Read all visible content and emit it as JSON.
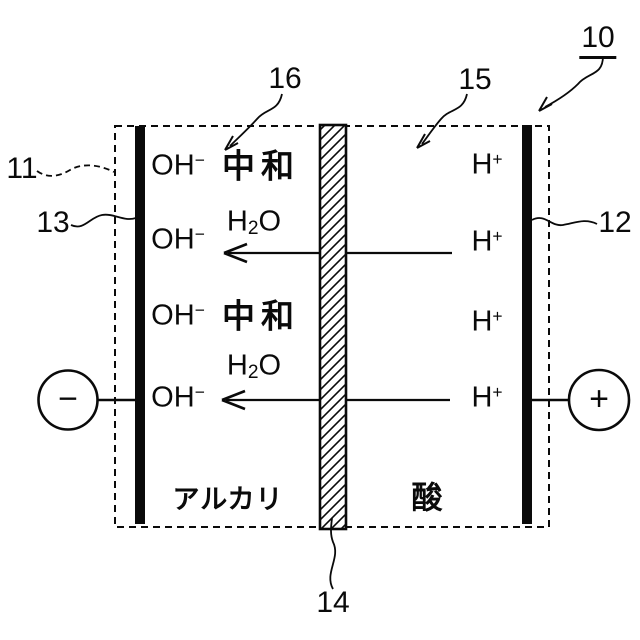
{
  "figure": {
    "background": "#ffffff",
    "line_color": "#0a0a0a"
  },
  "reference_labels": {
    "overall": "10",
    "vessel": "11",
    "right_electrode": "12",
    "left_electrode": "13",
    "membrane": "14",
    "acid_side": "15",
    "neutralization_site": "16"
  },
  "chambers": {
    "left": "アルカリ",
    "right": "酸"
  },
  "reaction": {
    "neutralize": "中和"
  },
  "ions": {
    "hydroxide": {
      "base": "OH",
      "charge": "−"
    },
    "hydrogen": {
      "base": "H",
      "charge": "+"
    },
    "water": {
      "h": "H",
      "two": "2",
      "o": "O"
    }
  },
  "terminals": {
    "negative": "−",
    "positive": "+"
  }
}
